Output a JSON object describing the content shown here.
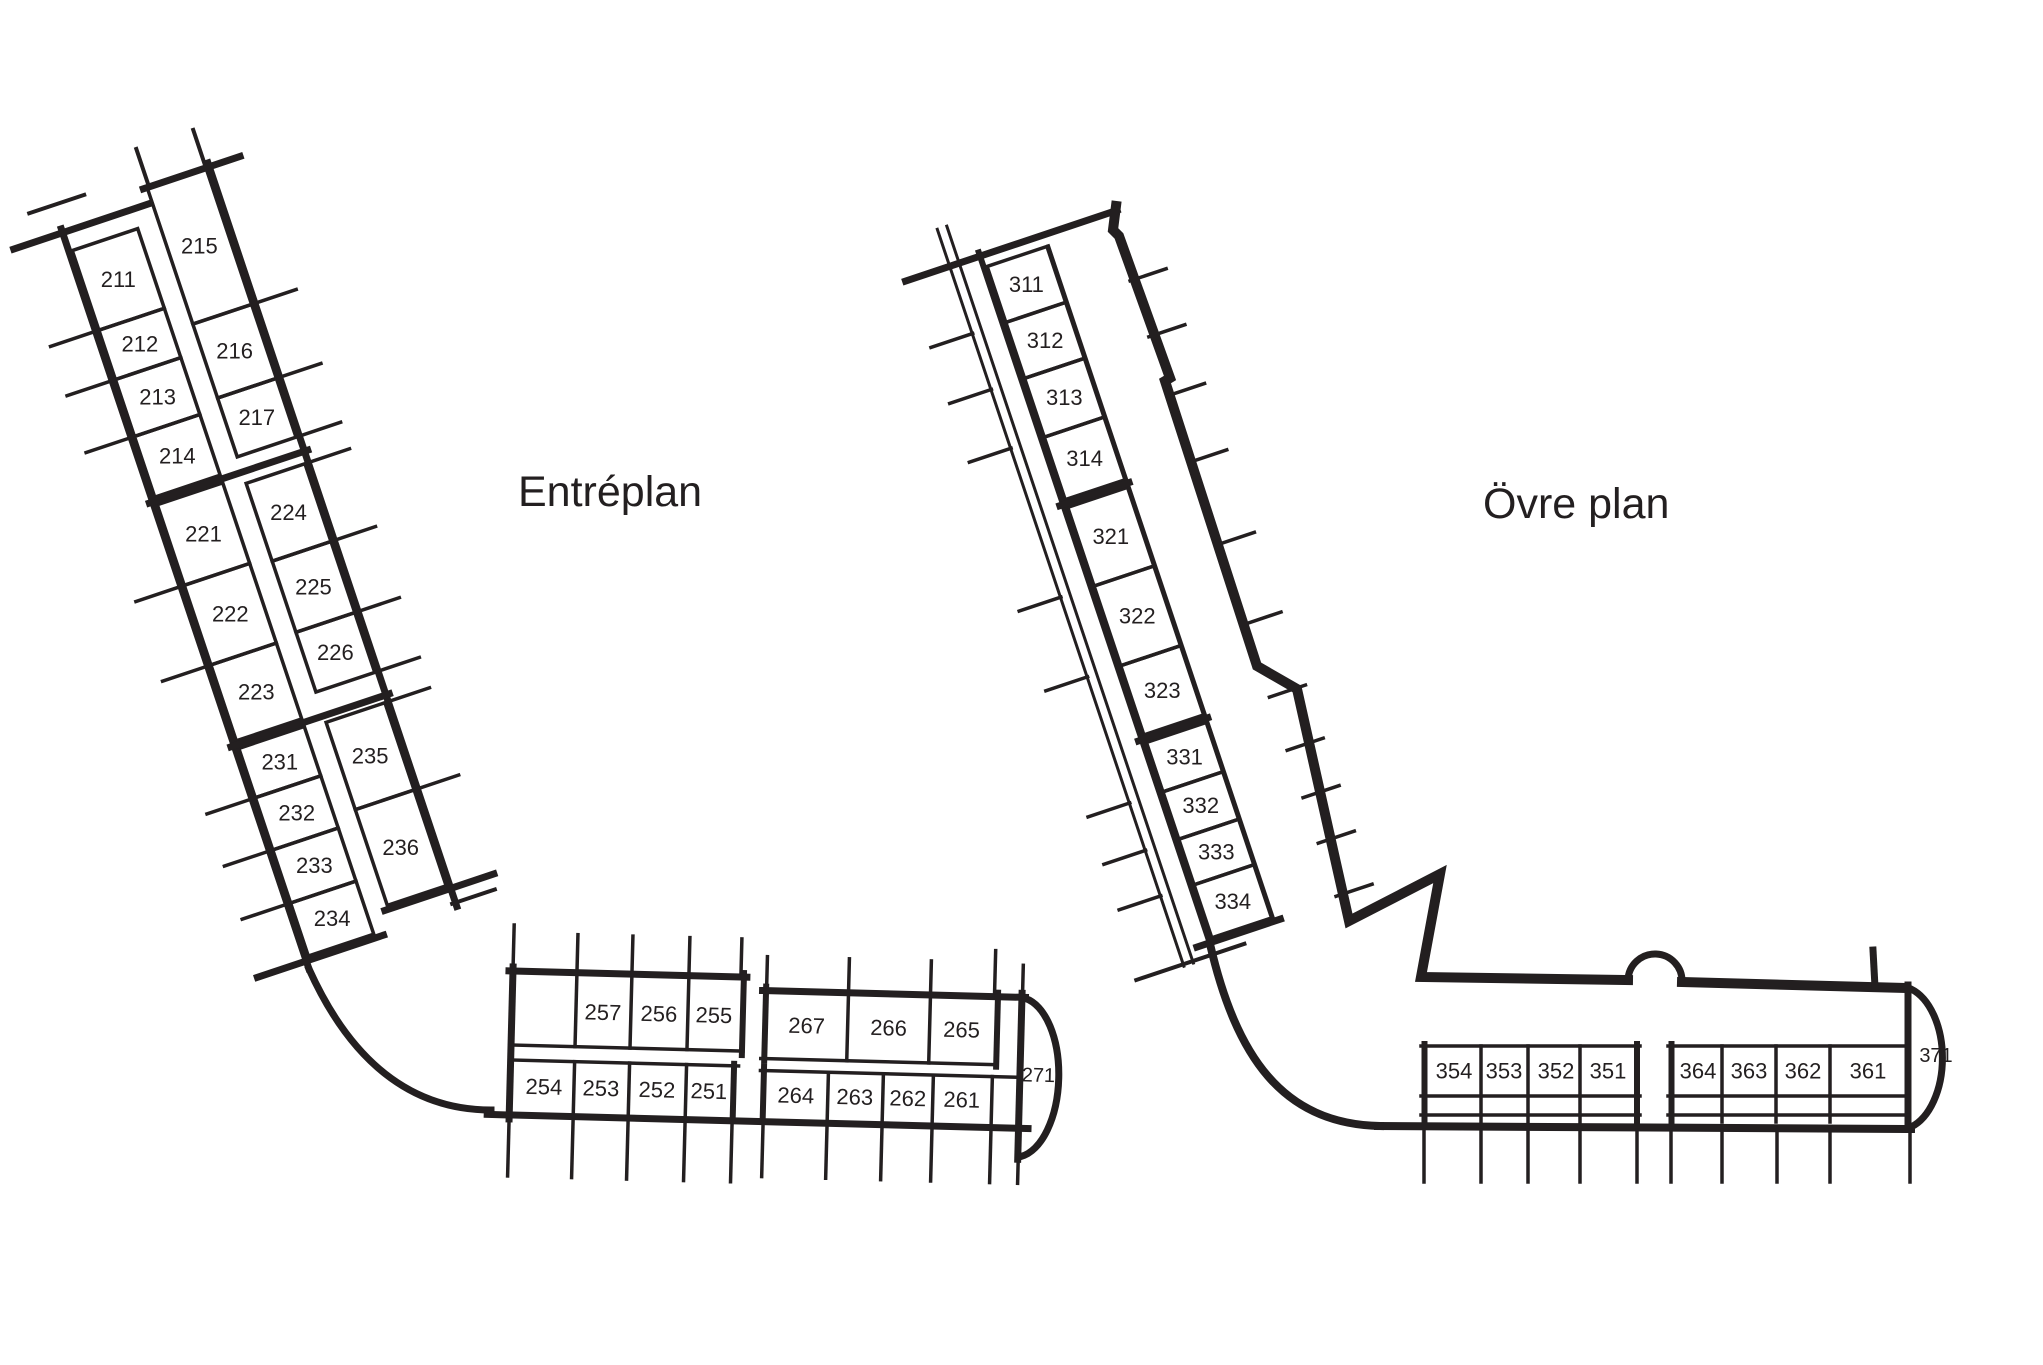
{
  "page": {
    "background_color": "#ffffff",
    "ink_color": "#231f20",
    "type": "floor-plan"
  },
  "titles": {
    "entreplan": "Entréplan",
    "ovre_plan": "Övre plan"
  },
  "entreplan": {
    "wing": {
      "west_rooms": [
        "211",
        "212",
        "213",
        "214",
        "221",
        "222",
        "223",
        "231",
        "232",
        "233",
        "234"
      ],
      "east_rooms": [
        "215",
        "216",
        "217",
        "224",
        "225",
        "226",
        "235",
        "236"
      ]
    },
    "base": {
      "upper_row_west": [
        "257",
        "256",
        "255"
      ],
      "upper_row_east": [
        "267",
        "266",
        "265"
      ],
      "lower_row_west": [
        "254",
        "253",
        "252",
        "251"
      ],
      "lower_row_east": [
        "264",
        "263",
        "262",
        "261"
      ],
      "end_room": "271"
    }
  },
  "ovre_plan": {
    "wing": {
      "rooms": [
        "311",
        "312",
        "313",
        "314",
        "321",
        "322",
        "323",
        "331",
        "332",
        "333",
        "334"
      ]
    },
    "base": {
      "west_block": [
        "354",
        "353",
        "352",
        "351"
      ],
      "east_block": [
        "364",
        "363",
        "362",
        "361"
      ],
      "end_room": "371"
    }
  }
}
